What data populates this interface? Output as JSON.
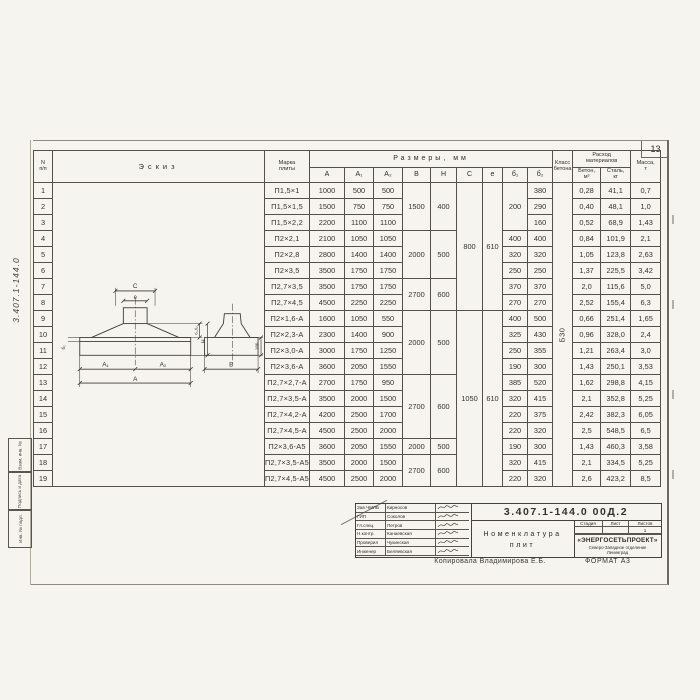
{
  "page": {
    "number": "13"
  },
  "frame": {
    "doc_number_vertical": "3.407.1-144.0",
    "stamps": [
      "Взам. инв. №",
      "Подпись и дата",
      "Инв. № подл."
    ]
  },
  "table": {
    "headers": {
      "num_top": "N",
      "num_bottom": "п/п",
      "sketch": "Эскиз",
      "mark_top": "Марка",
      "mark_bottom": "плиты",
      "dims": "Размеры, мм",
      "dim_cols": [
        "А",
        "А₁",
        "А₂",
        "В",
        "Н",
        "С",
        "е",
        "б₁",
        "б₂"
      ],
      "class_top": "Класс",
      "class_bottom": "бетона",
      "consumption_top": "Расход",
      "consumption_bottom": "материалов",
      "concrete_top": "Бетон,",
      "concrete_bottom": "м³",
      "steel_top": "Сталь,",
      "steel_bottom": "кг",
      "mass_top": "Масса,",
      "mass_bottom": "т"
    },
    "rows": [
      [
        "1",
        "П1,5×1",
        "1000",
        "500",
        "500",
        [
          "1500",
          3
        ],
        [
          "400",
          3
        ],
        [
          "800",
          8
        ],
        [
          "610",
          8
        ],
        [
          "200",
          3
        ],
        "380",
        [
          "Б30",
          19
        ],
        "0,28",
        "41,1",
        "0,7"
      ],
      [
        "2",
        "П1,5×1,5",
        "1500",
        "750",
        "750",
        null,
        null,
        null,
        null,
        null,
        "290",
        null,
        "0,40",
        "48,1",
        "1,0"
      ],
      [
        "3",
        "П1,5×2,2",
        "2200",
        "1100",
        "1100",
        null,
        null,
        null,
        null,
        null,
        "160",
        null,
        "0,52",
        "68,9",
        "1,43"
      ],
      [
        "4",
        "П2×2,1",
        "2100",
        "1050",
        "1050",
        [
          "2000",
          3
        ],
        [
          "500",
          3
        ],
        null,
        null,
        "400",
        "400",
        null,
        "0,84",
        "101,9",
        "2,1"
      ],
      [
        "5",
        "П2×2,8",
        "2800",
        "1400",
        "1400",
        null,
        null,
        null,
        null,
        "320",
        "320",
        null,
        "1,05",
        "123,8",
        "2,63"
      ],
      [
        "6",
        "П2×3,5",
        "3500",
        "1750",
        "1750",
        null,
        null,
        null,
        null,
        "250",
        "250",
        null,
        "1,37",
        "225,5",
        "3,42"
      ],
      [
        "7",
        "П2,7×3,5",
        "3500",
        "1750",
        "1750",
        [
          "2700",
          2
        ],
        [
          "600",
          2
        ],
        null,
        null,
        "370",
        "370",
        null,
        "2,0",
        "115,6",
        "5,0"
      ],
      [
        "8",
        "П2,7×4,5",
        "4500",
        "2250",
        "2250",
        null,
        null,
        null,
        null,
        "270",
        "270",
        null,
        "2,52",
        "155,4",
        "6,3"
      ],
      [
        "9",
        "П2×1,6-А",
        "1600",
        "1050",
        "550",
        [
          "2000",
          4
        ],
        [
          "500",
          4
        ],
        [
          "1050",
          11
        ],
        [
          "610",
          11
        ],
        "400",
        "500",
        null,
        "0,66",
        "251,4",
        "1,65"
      ],
      [
        "10",
        "П2×2,3-А",
        "2300",
        "1400",
        "900",
        null,
        null,
        null,
        null,
        "325",
        "430",
        null,
        "0,96",
        "328,0",
        "2,4"
      ],
      [
        "11",
        "П2×3,0-А",
        "3000",
        "1750",
        "1250",
        null,
        null,
        null,
        null,
        "250",
        "355",
        null,
        "1,21",
        "263,4",
        "3,0"
      ],
      [
        "12",
        "П2×3,6-А",
        "3600",
        "2050",
        "1550",
        null,
        null,
        null,
        null,
        "190",
        "300",
        null,
        "1,43",
        "250,1",
        "3,53"
      ],
      [
        "13",
        "П2,7×2,7-А",
        "2700",
        "1750",
        "950",
        [
          "2700",
          4
        ],
        [
          "600",
          4
        ],
        null,
        null,
        "385",
        "520",
        null,
        "1,62",
        "298,8",
        "4,15"
      ],
      [
        "14",
        "П2,7×3,5-А",
        "3500",
        "2000",
        "1500",
        null,
        null,
        null,
        null,
        "320",
        "415",
        null,
        "2,1",
        "352,8",
        "5,25"
      ],
      [
        "15",
        "П2,7×4,2-А",
        "4200",
        "2500",
        "1700",
        null,
        null,
        null,
        null,
        "220",
        "375",
        null,
        "2,42",
        "382,3",
        "6,05"
      ],
      [
        "16",
        "П2,7×4,5-А",
        "4500",
        "2500",
        "2000",
        null,
        null,
        null,
        null,
        "220",
        "320",
        null,
        "2,5",
        "548,5",
        "6,5"
      ],
      [
        "17",
        "П2×3,6-А5",
        "3600",
        "2050",
        "1550",
        [
          "2000",
          1
        ],
        [
          "500",
          1
        ],
        null,
        null,
        "190",
        "300",
        null,
        "1,43",
        "460,3",
        "3,58"
      ],
      [
        "18",
        "П2,7×3,5-А5",
        "3500",
        "2000",
        "1500",
        [
          "2700",
          2
        ],
        [
          "600",
          2
        ],
        null,
        null,
        "320",
        "415",
        null,
        "2,1",
        "334,5",
        "5,25"
      ],
      [
        "19",
        "П2,7×4,5-А5",
        "4500",
        "2500",
        "2000",
        null,
        null,
        null,
        null,
        "220",
        "320",
        null,
        "2,6",
        "423,2",
        "8,5"
      ]
    ]
  },
  "sketch_labels": {
    "c": "С",
    "e": "е",
    "a1": "А₁",
    "a2": "А₂",
    "a": "А",
    "b": "В",
    "d12": "б₁,б₂",
    "h": "Н",
    "d2": "б₂",
    "n180": "180"
  },
  "title_block": {
    "doc_number": "3.407.1-144.0  00Д.2",
    "title_top": "Номенклатура",
    "title_bottom": "плит",
    "stage_label": "Стадия",
    "sheet_label": "Лист",
    "sheets_label": "Листов",
    "sheets_value": "1",
    "org_name": "«ЭНЕРГОСЕТЬПРОЕКТ»",
    "org_branch": "Северо-Западное отделение",
    "org_city": "Ленинград",
    "people": [
      {
        "role": "Зав.ЧМЛБ",
        "name": "Кирносов"
      },
      {
        "role": "ГИП",
        "name": "Соколов"
      },
      {
        "role": "Гл.спец.",
        "name": "Петров"
      },
      {
        "role": "Н.контр.",
        "name": "Канаевская"
      },
      {
        "role": "Проверил",
        "name": "Чукинская"
      },
      {
        "role": "Инженер",
        "name": "Беляевская"
      }
    ]
  },
  "footer": {
    "copied": "Копировала Владимирова Е.Б.",
    "format": "ФОРМАТ А3"
  }
}
